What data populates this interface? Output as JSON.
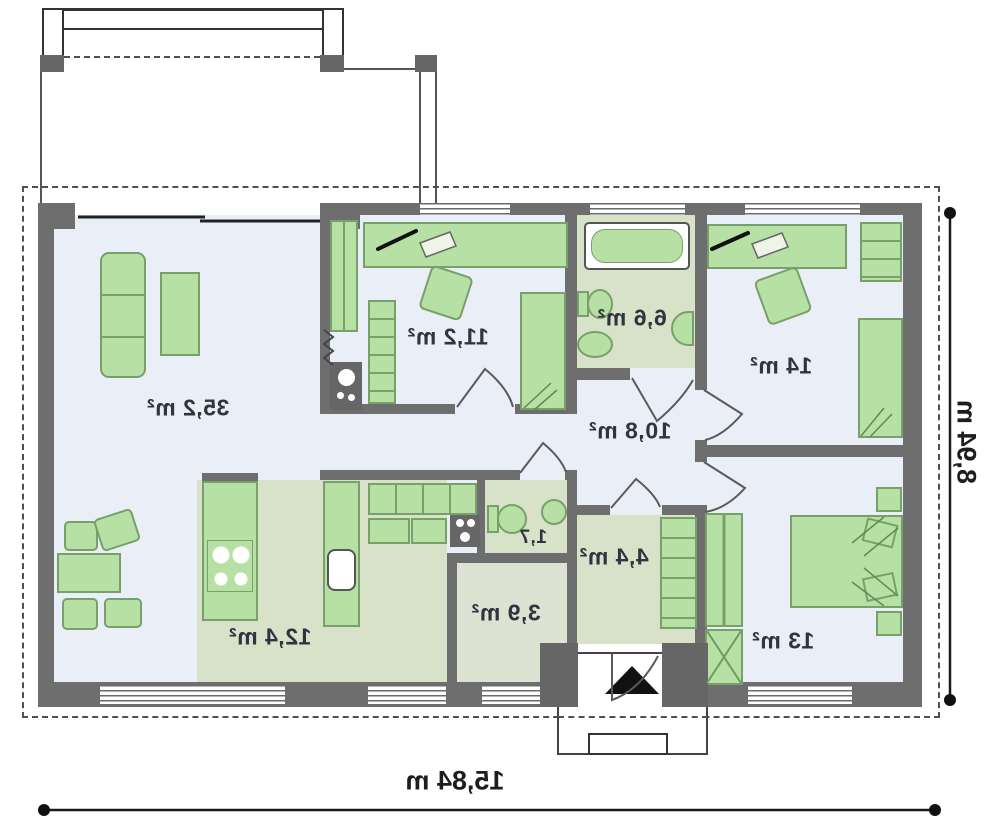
{
  "plan": {
    "rooms": [
      {
        "name": "living-room",
        "area_label": "35,2 m²"
      },
      {
        "name": "bedroom-top",
        "area_label": "11,2 m²"
      },
      {
        "name": "bathroom",
        "area_label": "6,6 m²"
      },
      {
        "name": "bedroom-right",
        "area_label": "14 m²"
      },
      {
        "name": "hall",
        "area_label": "10,8 m²"
      },
      {
        "name": "wc",
        "area_label": "1,7"
      },
      {
        "name": "storage",
        "area_label": "3,9 m²"
      },
      {
        "name": "entry",
        "area_label": "4,4 m²"
      },
      {
        "name": "kitchen",
        "area_label": "12,4 m²"
      },
      {
        "name": "bedroom-bottom",
        "area_label": "13 m²"
      }
    ],
    "dimensions": {
      "width_label": "15,84 m",
      "height_label": "8,94 m"
    },
    "colors": {
      "wall": "#6e6e6e",
      "floor": "#e9eef7",
      "wet_floor": "#d8e2c9",
      "furniture": "#b7e0a4",
      "furniture_border": "#78a06b"
    }
  }
}
